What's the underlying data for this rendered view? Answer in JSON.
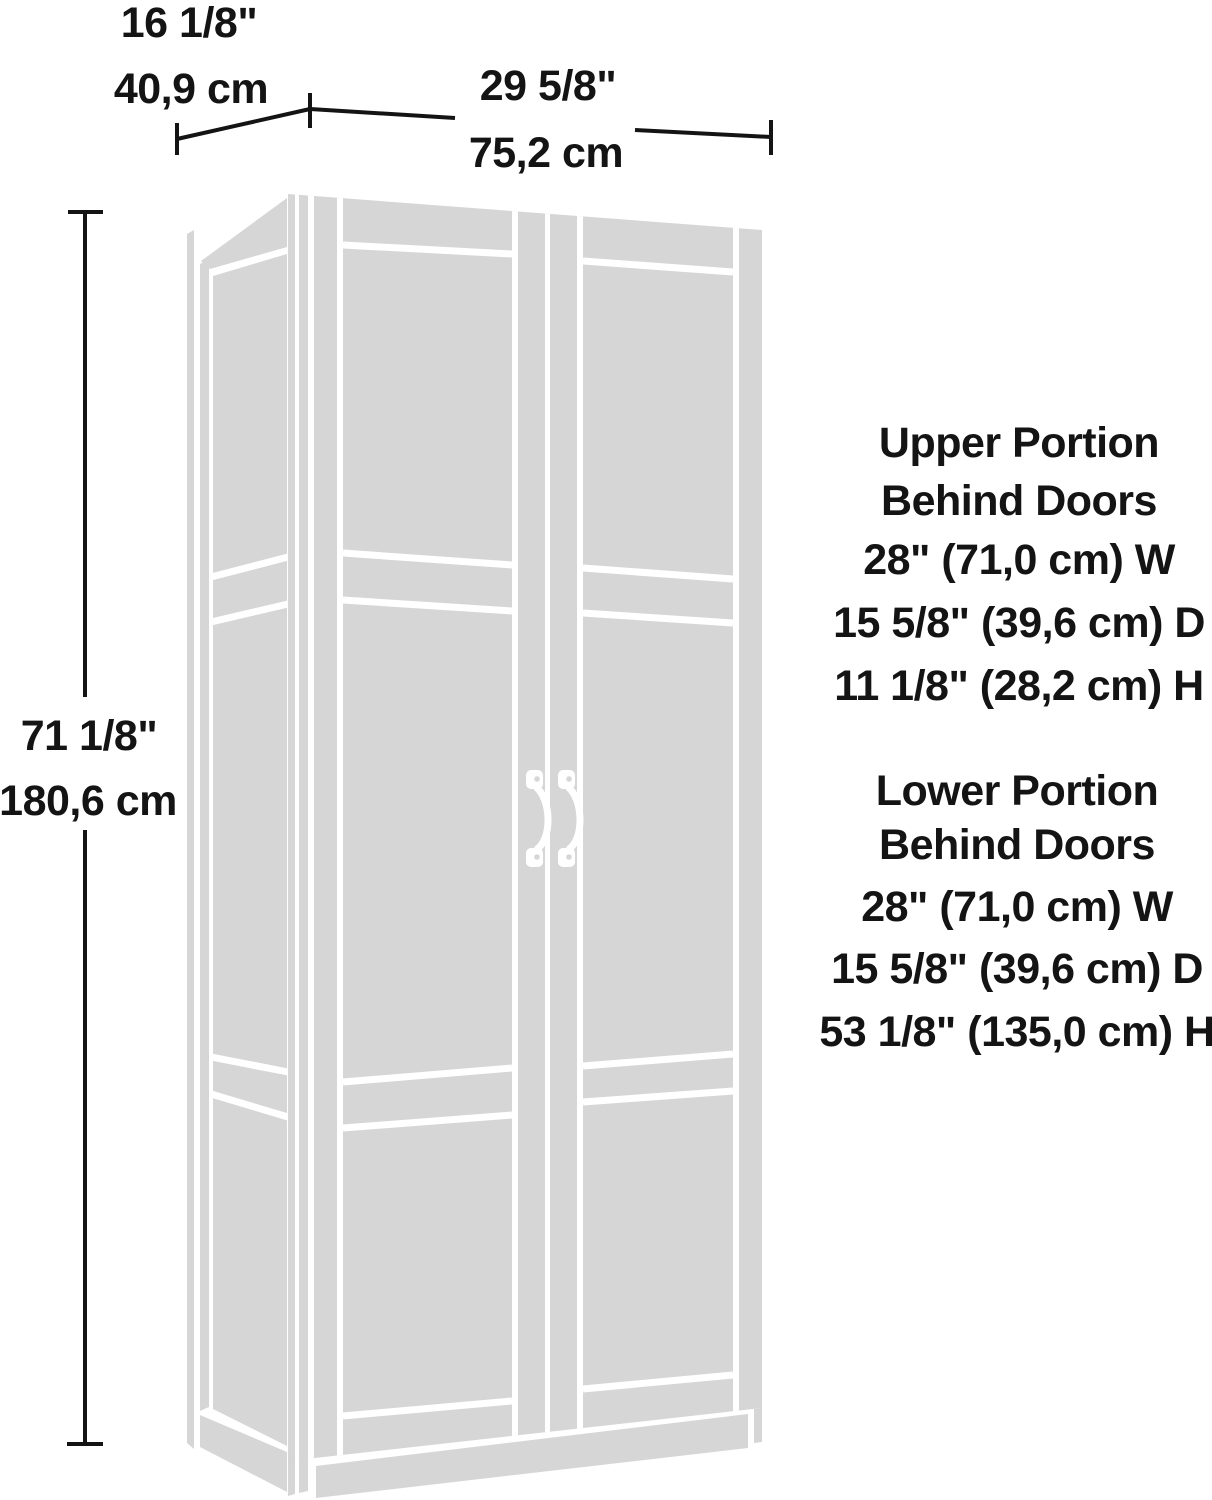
{
  "title": "Storage cabinet dimension diagram",
  "dimensions": {
    "depth": {
      "inches": "16 1/8\"",
      "cm": "40,9 cm"
    },
    "width": {
      "inches": "29 5/8\"",
      "cm": "75,2 cm"
    },
    "height": {
      "inches": "71 1/8\"",
      "cm": "180,6 cm"
    }
  },
  "upper_portion": {
    "line1": "Upper Portion",
    "line2": "Behind Doors",
    "width": "28\" (71,0 cm) W",
    "depth": "15 5/8\" (39,6 cm) D",
    "height": "11 1/8\" (28,2 cm) H"
  },
  "lower_portion": {
    "line1": "Lower Portion",
    "line2": "Behind Doors",
    "width": "28\" (71,0 cm) W",
    "depth": "15 5/8\" (39,6 cm) D",
    "height": "53 1/8\" (135,0 cm) H"
  },
  "colors": {
    "cabinet": "#d6d6d6",
    "groove": "#ffffff",
    "line": "#141414",
    "background": "#ffffff"
  }
}
